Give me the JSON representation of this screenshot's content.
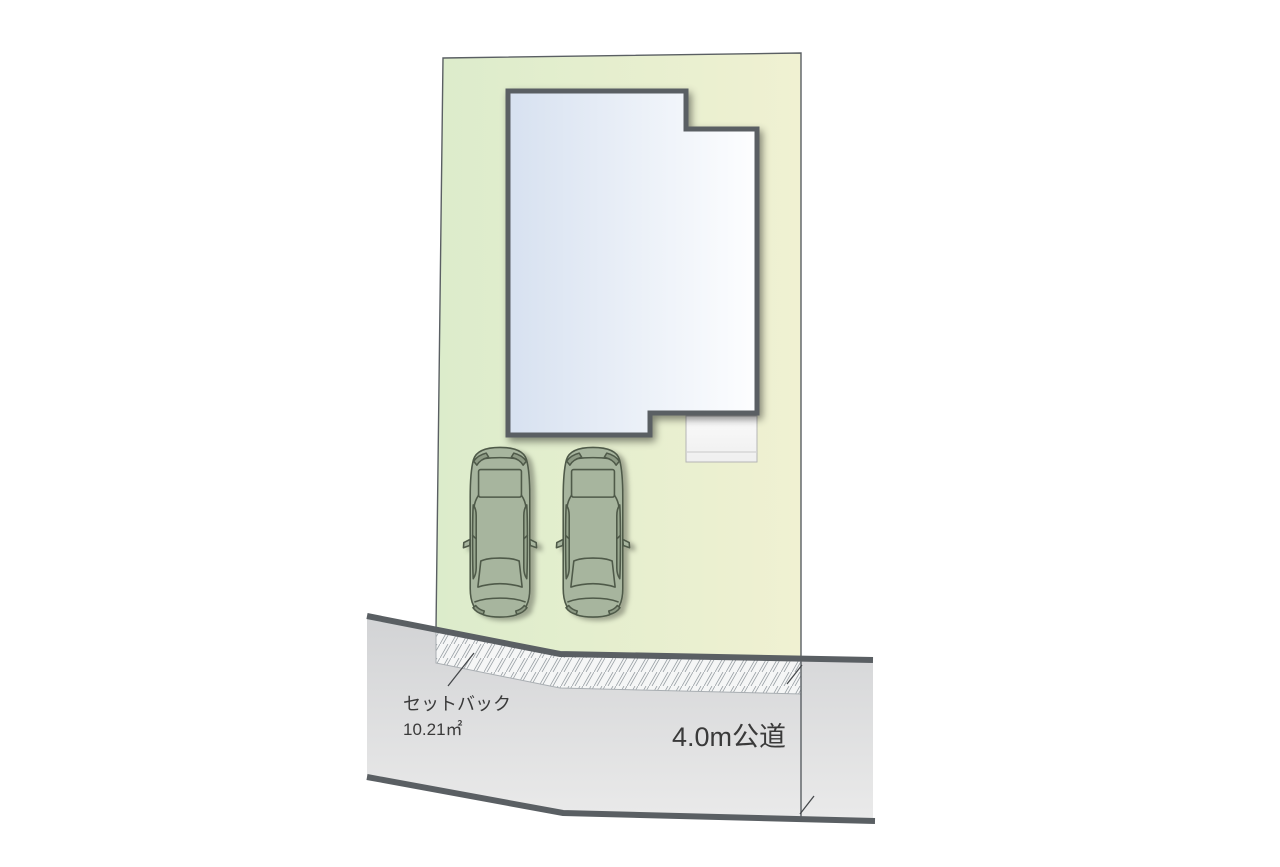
{
  "plan": {
    "setback_label": "セットバック",
    "setback_area": "10.21㎡",
    "road_label": "4.0m公道"
  },
  "colors": {
    "lot_green": "#dceccb",
    "lot_yellow": "#f0f1d2",
    "building_blue": "#d7e1f0",
    "building_white": "#fdfeff",
    "outline_dark": "#5a5f63",
    "road_gray_top": "#d2d3d5",
    "road_gray_bottom": "#eaeaea",
    "hatch_bg": "#f5f6f6",
    "hatch_line": "#99a0a5",
    "porch_white": "#fafafa",
    "car_body": "#a7b59e",
    "car_panel_dark": "#8d9a84",
    "car_outline": "#4f5a49",
    "label_color": "#3a3a3a"
  }
}
